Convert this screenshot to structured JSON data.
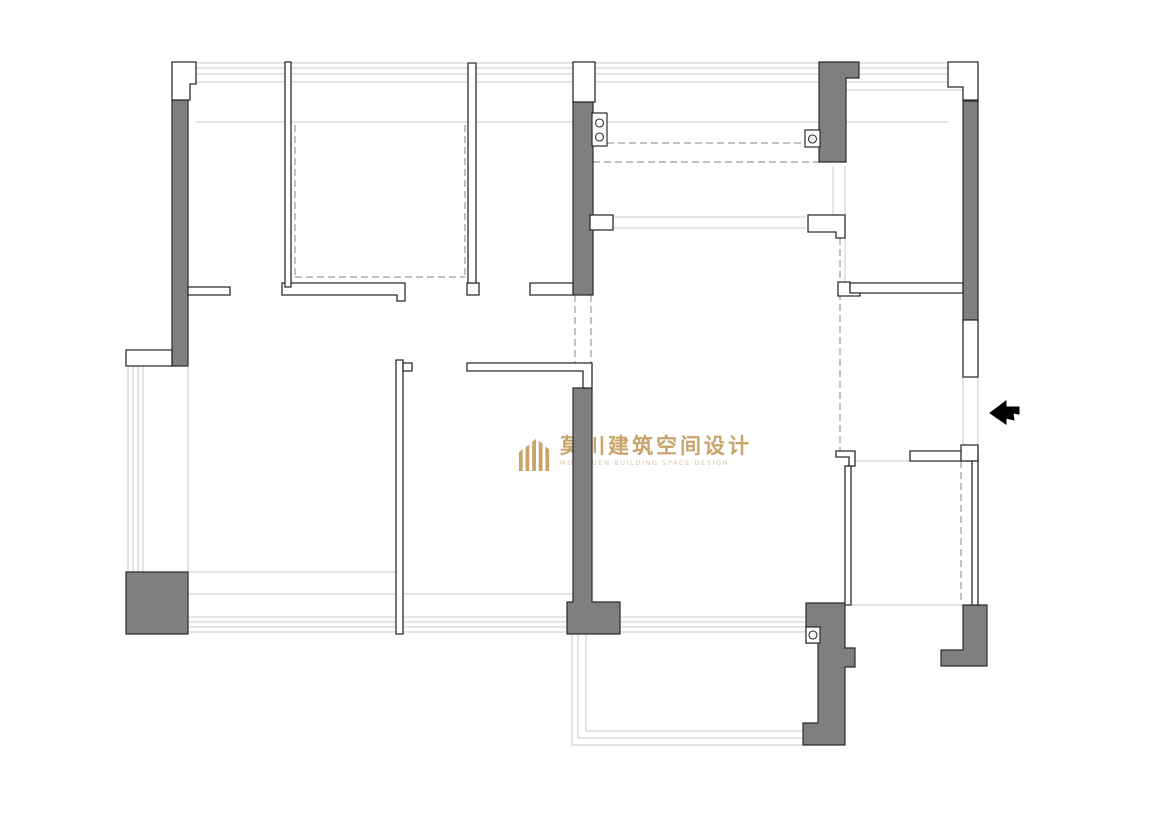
{
  "watermark": {
    "cn": "莫川建筑空间设计",
    "en": "MOKCHUEN BUILDING SPACE DESIGN"
  },
  "palette": {
    "wall_gray": "#7f7f7f",
    "outline": "#2b2b2b",
    "light_line": "#c9c9c9",
    "dashed_line": "#9a9a9a",
    "arrow_black": "#000000",
    "logo_gold": "#c69f63"
  },
  "plan": {
    "light_lines": [
      [
        196,
        63,
        948,
        63
      ],
      [
        196,
        68,
        948,
        68
      ],
      [
        196,
        74,
        948,
        74
      ],
      [
        196,
        82,
        948,
        82
      ],
      [
        845,
        90,
        963,
        90
      ],
      [
        196,
        122,
        948,
        122
      ],
      [
        188,
        295,
        188,
        572
      ],
      [
        128,
        366,
        128,
        572
      ],
      [
        133,
        366,
        133,
        572
      ],
      [
        138,
        366,
        138,
        572
      ],
      [
        143,
        366,
        143,
        572
      ],
      [
        188,
        572,
        400,
        572
      ],
      [
        188,
        594,
        574,
        594
      ],
      [
        188,
        617,
        818,
        617
      ],
      [
        188,
        622,
        818,
        622
      ],
      [
        188,
        627,
        818,
        627
      ],
      [
        188,
        632,
        818,
        632
      ],
      [
        572,
        634,
        572,
        745
      ],
      [
        578,
        634,
        578,
        738
      ],
      [
        586,
        634,
        586,
        731
      ],
      [
        572,
        745,
        845,
        745
      ],
      [
        578,
        738,
        840,
        738
      ],
      [
        586,
        731,
        830,
        731
      ],
      [
        613,
        217,
        806,
        217
      ],
      [
        613,
        228,
        806,
        228
      ],
      [
        833,
        166,
        833,
        215
      ],
      [
        845,
        166,
        845,
        215
      ],
      [
        845,
        238,
        845,
        283
      ],
      [
        963,
        377,
        963,
        447
      ],
      [
        978,
        377,
        978,
        447
      ],
      [
        855,
        461,
        910,
        461
      ],
      [
        851,
        605,
        963,
        605
      ]
    ],
    "dashed_lines": [
      [
        295,
        125,
        295,
        277
      ],
      [
        295,
        277,
        465,
        277
      ],
      [
        465,
        125,
        465,
        277
      ],
      [
        607,
        143,
        806,
        143
      ],
      [
        593,
        162,
        820,
        162
      ],
      [
        575,
        295,
        575,
        363
      ],
      [
        591,
        295,
        591,
        363
      ],
      [
        840,
        238,
        840,
        451
      ],
      [
        961,
        461,
        961,
        601
      ]
    ],
    "gray_walls": [
      "M172,100 H188 V366 H172 Z",
      "M126,572 H188 V634 H126 Z",
      "M573,102 H593 V295 H573 Z",
      "M573,388 H592 V602 H620 V634 H567 V602 H573 Z",
      "M819,62 H859 V78 H846 V162 H819 Z",
      "M963,101 H978 V320 H963 Z",
      "M806,603 H845 V648 H855 V667 H845 V745 H803 V723 H818 V643 H806 Z",
      "M963,605 H987 V666 H941 V650 H963 Z"
    ],
    "white_walls": [
      "M172,62 H196 V84 H190 V100 H172 Z",
      "M573,62 H595 V102 H573 Z",
      "M948,62 H978 V100 H963 V87 H948 Z",
      "M126,350 H172 V366 H126 Z",
      "M963,320 H978 V377 H963 Z",
      "M590,215 H613 V230 H590 Z",
      "M808,215 H845 V238 H836 V232 H808 Z",
      "M838,282 H850 V288 H860 V296 H838 Z",
      "M188,287 H230 V295 H188 Z",
      "M282,283 H405 V301 H397 V295 H282 Z",
      "M467,283 H479 V295 H467 Z",
      "M530,283 H573 V295 H530 Z",
      "M850,283 H963 V293 H850 Z",
      "M285,62 H291 V287 H285 Z",
      "M468,63 H476 V283 H468 Z",
      "M396,360 H403 V634 H396 Z",
      "M403,363 H412 V371 H403 Z",
      "M467,363 H592 V388 H583 V371 H467 Z",
      "M910,451 H978 V461 H910 Z",
      "M961,445 H978 V461 H961 Z",
      "M972,461 H978 V605 H972 Z",
      "M845,466 H851 V605 H845 Z",
      "M836,451 H855 V466 H849 V457 H836 Z"
    ],
    "circle_boxes": [
      {
        "x": 592,
        "y": 113,
        "w": 15,
        "h": 33,
        "circles": [
          [
            599.5,
            123,
            4
          ],
          [
            599.5,
            137,
            4
          ]
        ]
      },
      {
        "x": 805,
        "y": 130,
        "w": 15,
        "h": 17,
        "circles": [
          [
            812.5,
            139,
            4
          ]
        ]
      },
      {
        "x": 806,
        "y": 627,
        "w": 14,
        "h": 16,
        "circles": [
          [
            813,
            635,
            4
          ]
        ]
      }
    ],
    "entry_arrow": "M990,413 L1006,401 L1006,407 L1019,407 L1019,414 L1013,413 L1014,420 L1006,418 L1006,424 Z"
  }
}
